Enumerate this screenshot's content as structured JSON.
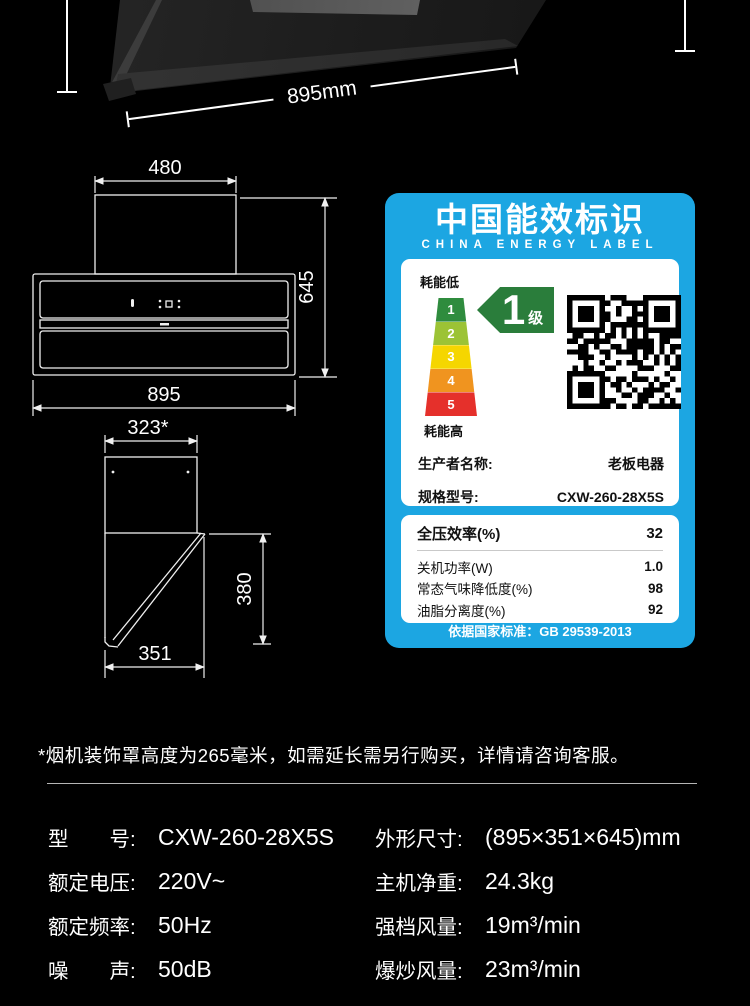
{
  "product_photo": {
    "width_label": "895mm"
  },
  "front_view": {
    "top_width_label": "480",
    "height_label": "645",
    "bottom_width_label": "895"
  },
  "side_view": {
    "top_width_label": "323*",
    "depth_label": "380",
    "bottom_width_label": "351"
  },
  "energy_label": {
    "title": "中国能效标识",
    "subtitle": "CHINA ENERGY LABEL",
    "scale_top_label": "耗能低",
    "scale_bottom_label": "耗能高",
    "levels": [
      "1",
      "2",
      "3",
      "4",
      "5"
    ],
    "level_colors": [
      "#2f8c3e",
      "#9cc335",
      "#f5d600",
      "#f0941f",
      "#e5302b"
    ],
    "rating_value": "1",
    "rating_unit": "级",
    "brand_blue": "#1ca6e2",
    "fields": [
      {
        "label": "生产者名称:",
        "value": "老板电器"
      },
      {
        "label": "规格型号:",
        "value": "CXW-260-28X5S"
      }
    ],
    "metrics": [
      {
        "label": "全压效率(%)",
        "value": "32"
      },
      {
        "label": "关机功率(W)",
        "value": "1.0"
      },
      {
        "label": "常态气味降低度(%)",
        "value": "98"
      },
      {
        "label": "油脂分离度(%)",
        "value": "92"
      }
    ],
    "footer": "依据国家标准：GB 29539-2013"
  },
  "note": "*烟机装饰罩高度为265毫米，如需延长需另行购买，详情请咨询客服。",
  "specs": {
    "left": [
      {
        "label": "型　　号:",
        "value": "CXW-260-28X5S"
      },
      {
        "label": "额定电压:",
        "value": "220V~"
      },
      {
        "label": "额定频率:",
        "value": "50Hz"
      },
      {
        "label": "噪　　声:",
        "value": "50dB"
      }
    ],
    "right": [
      {
        "label": "外形尺寸:",
        "value": "(895×351×645)mm"
      },
      {
        "label": "主机净重:",
        "value": "24.3kg"
      },
      {
        "label": "强档风量:",
        "value": "19m³/min"
      },
      {
        "label": "爆炒风量:",
        "value": "23m³/min"
      }
    ]
  }
}
